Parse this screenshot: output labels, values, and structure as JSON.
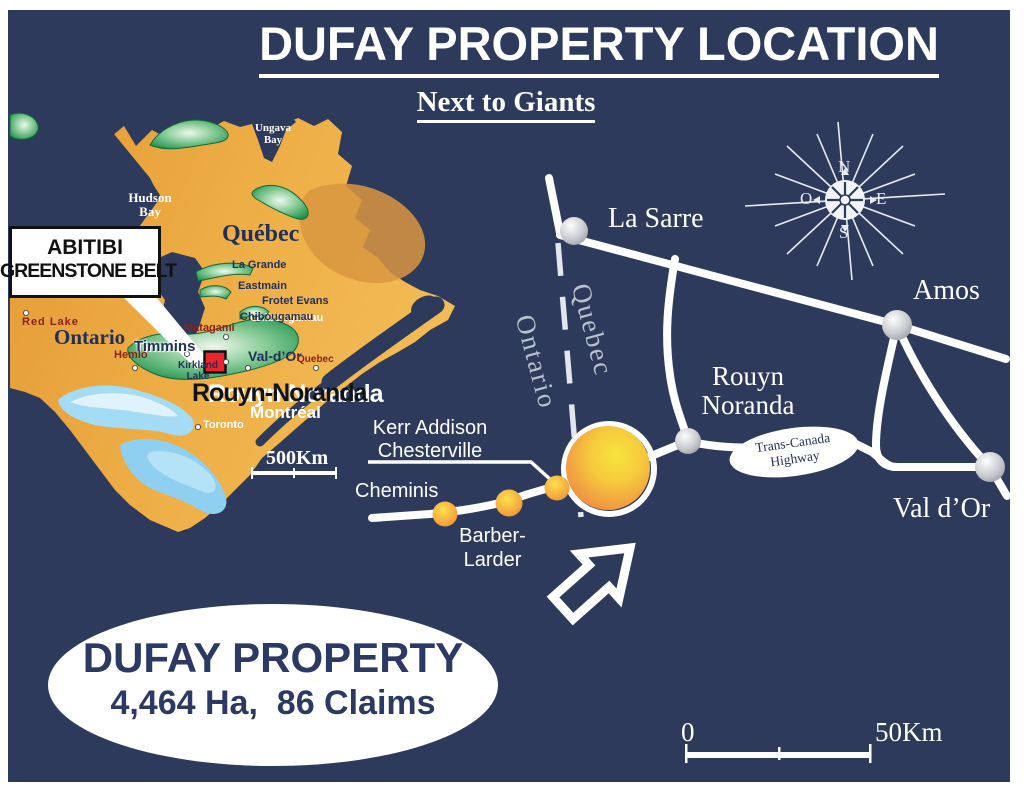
{
  "title": "DUFAY PROPERTY LOCATION",
  "subtitle": "Next to Giants",
  "callout_box": {
    "line1": "ABITIBI",
    "line2": "GREENSTONE BELT"
  },
  "inset_map": {
    "water_labels": {
      "ungava": "Ungava\nBay",
      "hudson": "Hudson\nBay",
      "james": "James\nBay"
    },
    "region_labels": {
      "quebec": "Québec",
      "ontario": "Ontario"
    },
    "place_labels": {
      "la_grande": "La Grande",
      "eastmain": "Eastmain",
      "frotet_evans": "Frotet Evans",
      "chibougamau": "Chibougamau",
      "matagami": "Matagami",
      "timmins": "Timmins",
      "hemlo": "Hemlo",
      "red_lake": "Red Lake",
      "kirkland_lake": "Kirkland\nLake",
      "val_dor": "Val-d’Or",
      "quebec_city": "Quebec",
      "rouyn_noranda": "Rouyn-Noranda",
      "montreal": "Montréal",
      "toronto": "Toronto"
    },
    "scale_label": "500Km"
  },
  "road_map": {
    "cities": {
      "la_sarre": "La Sarre",
      "amos": "Amos",
      "rouyn_noranda": "Rouyn\nNoranda",
      "val_dor": "Val d’Or"
    },
    "border_labels": {
      "ontario": "Ontario",
      "quebec": "Quebec"
    },
    "deposit_labels": {
      "kerr_addison": "Kerr Addison\nChesterville",
      "cheminis": "Cheminis",
      "barber_larder": "Barber-\nLarder"
    },
    "highway_label": "Trans-Canada\nHighway",
    "compass": {
      "n": "N",
      "s": "S",
      "e": "E",
      "o": "O"
    },
    "scale": {
      "start": "0",
      "end": "50Km"
    }
  },
  "property_badge": {
    "name": "DUFAY PROPERTY",
    "details": "4,464 Ha,  86 Claims"
  },
  "colors": {
    "background": "#2e3a5c",
    "land": "#eaa53f",
    "belt_green": "#1f9150",
    "lake_blue": "#a5dcf5",
    "marker_red": "#e8262c",
    "text_navy": "#2c3a63"
  }
}
